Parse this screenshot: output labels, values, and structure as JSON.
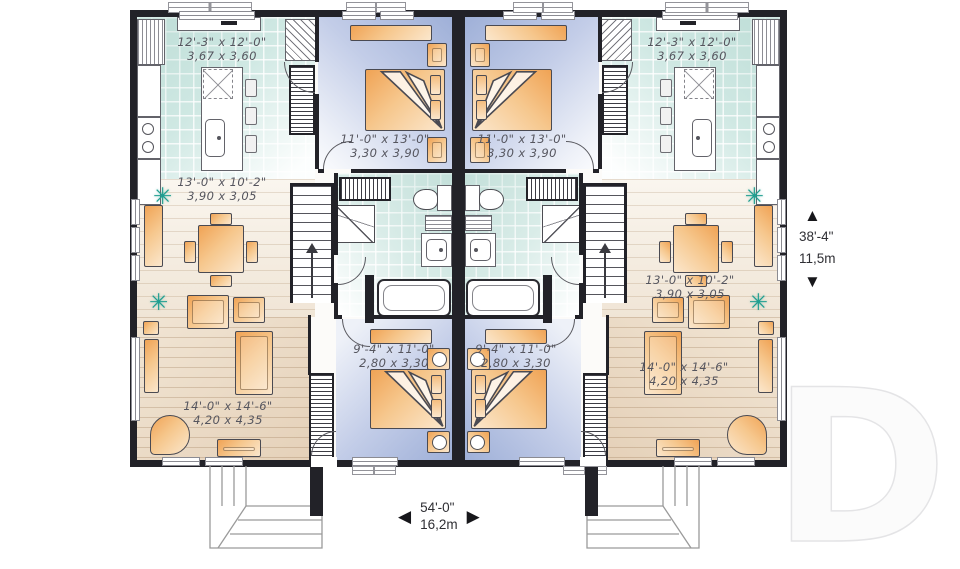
{
  "plan_labels": {
    "kitchen_left": {
      "imperial": "12'-3\" x 12'-0\"",
      "metric": "3,67 x 3,60"
    },
    "kitchen_right": {
      "imperial": "12'-3\" x 12'-0\"",
      "metric": "3,67 x 3,60"
    },
    "bedroom1_left": {
      "imperial": "11'-0\" x 13'-0\"",
      "metric": "3,30 x 3,90"
    },
    "bedroom1_right": {
      "imperial": "11'-0\" x 13'-0\"",
      "metric": "3,30 x 3,90"
    },
    "dining_left": {
      "imperial": "13'-0\" x 10'-2\"",
      "metric": "3,90 x 3,05"
    },
    "dining_right": {
      "imperial": "13'-0\" x 10'-2\"",
      "metric": "3,90 x 3,05"
    },
    "living_left": {
      "imperial": "14'-0\" x 14'-6\"",
      "metric": "4,20 x 4,35"
    },
    "living_right": {
      "imperial": "14'-0\" x 14'-6\"",
      "metric": "4,20 x 4,35"
    },
    "bedroom2_left": {
      "imperial": "9'-4\" x 11'-0\"",
      "metric": "2,80 x 3,30"
    },
    "bedroom2_right": {
      "imperial": "9'-4\" x 11'-0\"",
      "metric": "2,80 x 3,30"
    }
  },
  "overall_dimensions": {
    "depth": {
      "imperial": "38'-4\"",
      "metric": "11,5m"
    },
    "width": {
      "imperial": "54'-0\"",
      "metric": "16,2m"
    }
  },
  "icons": {
    "arrow_up": "▲",
    "arrow_down": "▼",
    "arrow_left": "◀",
    "arrow_right": "▶",
    "plant": "✳"
  },
  "watermark_letter": "D",
  "colors": {
    "wall": "#222228",
    "kitchen_tile": "#cfe8e3",
    "bedroom_floor": "#9fb0d8",
    "wood_floor": "#e5d1b9",
    "furniture": "#f0a355",
    "plant": "#1f9e90",
    "label_text": "#55555e",
    "dimension_text": "#2f2f34",
    "watermark": "#e4e4e6"
  }
}
